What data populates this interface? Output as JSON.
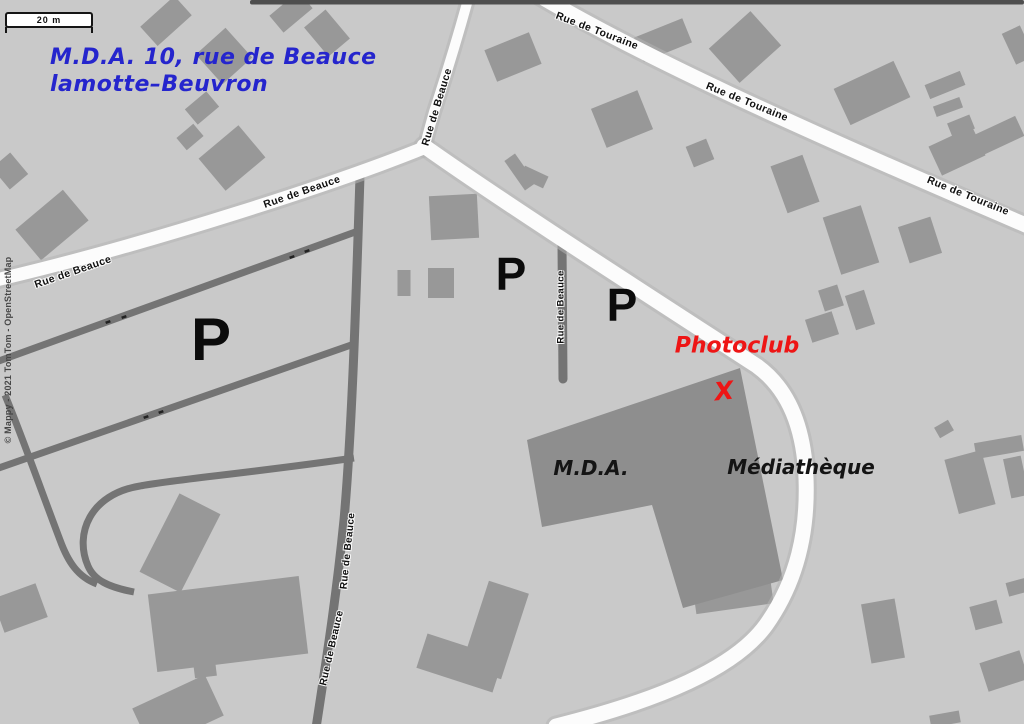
{
  "scale_bar": {
    "label": "20 m"
  },
  "copyright": "© Mappy - 2021 TomTom - OpenStreetMap",
  "annotation": {
    "address_line1": "M.D.A. 10, rue de Beauce",
    "address_line2": "lamotte–Beuvron",
    "photoclub": "Photoclub",
    "x_marker": "X",
    "mda": "M.D.A.",
    "mediatheque": "Médiathèque",
    "color_blue": "#2525cd",
    "color_red": "#ee1515",
    "color_black": "#141414"
  },
  "parking": {
    "symbol": "P",
    "markers": [
      {
        "x": 211,
        "y": 340,
        "size": 60
      },
      {
        "x": 511,
        "y": 274,
        "size": 46
      },
      {
        "x": 622,
        "y": 305,
        "size": 46
      }
    ]
  },
  "street_labels": [
    {
      "text": "Rue de Touraine",
      "x": 597,
      "y": 31,
      "rot": 21,
      "size": 10.5
    },
    {
      "text": "Rue de Touraine",
      "x": 747,
      "y": 102,
      "rot": 22,
      "size": 10.5
    },
    {
      "text": "Rue de Touraine",
      "x": 968,
      "y": 196,
      "rot": 22,
      "size": 10.5
    },
    {
      "text": "Rue de Beauce",
      "x": 437,
      "y": 107,
      "rot": -73,
      "size": 10.5
    },
    {
      "text": "Rue de Beauce",
      "x": 302,
      "y": 192,
      "rot": -19,
      "size": 10.5
    },
    {
      "text": "Rue de Beauce",
      "x": 73,
      "y": 272,
      "rot": -19,
      "size": 10.5
    },
    {
      "text": "Rue de Beauce",
      "x": 561,
      "y": 307,
      "rot": -90,
      "size": 9.5
    },
    {
      "text": "Rue de Beauce",
      "x": 348,
      "y": 551,
      "rot": -84,
      "size": 10
    },
    {
      "text": "Rue de Beauce",
      "x": 332,
      "y": 648,
      "rot": -77,
      "size": 10
    }
  ],
  "map": {
    "width": 1024,
    "height": 724,
    "colors": {
      "background": "#c9c9c9",
      "building": "#989898",
      "building_main": "#8e8e8e",
      "road_white": "#fcfcfc",
      "road_casing": "#b5b5b5",
      "road_minor": "#747474",
      "dot": "#222222"
    },
    "top_strip": {
      "x": 250,
      "h": 4.5,
      "color": "#4e4e4e"
    },
    "buildings": [
      [
        166,
        21,
        46,
        26,
        -42
      ],
      [
        224,
        56,
        40,
        40,
        -42
      ],
      [
        291,
        12,
        38,
        22,
        -40
      ],
      [
        327,
        33,
        28,
        38,
        -40
      ],
      [
        202,
        108,
        28,
        20,
        -40
      ],
      [
        232,
        158,
        52,
        42,
        -40
      ],
      [
        190,
        137,
        22,
        16,
        -40
      ],
      [
        52,
        225,
        62,
        40,
        -40
      ],
      [
        10,
        171,
        24,
        28,
        -40
      ],
      [
        513,
        57,
        48,
        34,
        -22
      ],
      [
        663,
        40,
        52,
        26,
        -22
      ],
      [
        622,
        119,
        50,
        42,
        -22
      ],
      [
        700,
        153,
        22,
        22,
        -22
      ],
      [
        745,
        47,
        56,
        46,
        -42
      ],
      [
        872,
        93,
        66,
        40,
        -25
      ],
      [
        945,
        85,
        38,
        15,
        -22
      ],
      [
        948,
        107,
        28,
        11,
        -20
      ],
      [
        961,
        126,
        24,
        15,
        -22
      ],
      [
        998,
        136,
        48,
        22,
        -25
      ],
      [
        1018,
        45,
        20,
        34,
        -25
      ],
      [
        957,
        151,
        48,
        32,
        -25
      ],
      [
        795,
        184,
        34,
        50,
        -20
      ],
      [
        851,
        240,
        40,
        60,
        -18
      ],
      [
        920,
        240,
        34,
        38,
        -18
      ],
      [
        831,
        298,
        20,
        22,
        -18
      ],
      [
        860,
        310,
        20,
        36,
        -18
      ],
      [
        822,
        327,
        28,
        24,
        -18
      ],
      [
        944,
        429,
        16,
        12,
        -30
      ],
      [
        999,
        447,
        48,
        16,
        -10
      ],
      [
        970,
        482,
        38,
        56,
        -15
      ],
      [
        1016,
        477,
        18,
        40,
        -12
      ],
      [
        883,
        631,
        34,
        60,
        -10
      ],
      [
        1018,
        587,
        22,
        14,
        -15
      ],
      [
        986,
        615,
        28,
        24,
        -15
      ],
      [
        1004,
        671,
        42,
        30,
        -18
      ],
      [
        945,
        719,
        30,
        12,
        -10
      ],
      [
        454,
        217,
        48,
        44,
        -3
      ],
      [
        404,
        283,
        13,
        26,
        0
      ],
      [
        441,
        283,
        26,
        30,
        0
      ],
      [
        520,
        172,
        13,
        36,
        -35
      ],
      [
        534,
        177,
        26,
        13,
        25
      ],
      [
        495,
        630,
        42,
        90,
        18
      ],
      [
        460,
        663,
        80,
        36,
        18
      ],
      [
        731,
        580,
        78,
        58,
        -8
      ],
      [
        180,
        543,
        46,
        88,
        27
      ],
      [
        228,
        624,
        152,
        78,
        -7
      ],
      [
        205,
        669,
        22,
        16,
        -7
      ],
      [
        20,
        608,
        46,
        36,
        -20
      ],
      [
        178,
        712,
        80,
        45,
        -25
      ]
    ],
    "polygons": [
      {
        "id": "mediatheque-mda-building",
        "points": "527,440 740,368 783,580 683,608 652,505 542,527",
        "fill": "#8e8e8e"
      }
    ],
    "roads": {
      "white": [
        {
          "id": "rue-de-touraine",
          "d": "M 540,-4 C 640,55 780,120 1028,226",
          "w": 15
        },
        {
          "id": "rue-de-beauce-north",
          "d": "M 469,-4 C 452,58 441,90 434,112 C 429,130 426,140 424,150",
          "w": 10
        },
        {
          "id": "rue-de-beauce-sw",
          "d": "M 426,147 C 340,182 150,244 -4,280",
          "w": 13
        },
        {
          "id": "main-road-southeast",
          "d": "M 424,146 C 500,200 640,290 757,366 C 790,390 804,430 806,478 C 808,530 798,580 766,625 C 735,668 660,700 556,726",
          "w": 15
        }
      ],
      "minor": [
        {
          "id": "rue-de-beauce-south",
          "d": "M 360,176 C 356,300 352,430 344,520 C 336,600 326,662 316,728",
          "w": 9
        },
        {
          "id": "rue-de-beauce-stub",
          "d": "M 562,243 L 563,379",
          "w": 9,
          "cap": "round"
        },
        {
          "id": "parking-aisle-1",
          "d": "M 358,231 L -4,362",
          "w": 7
        },
        {
          "id": "parking-aisle-2",
          "d": "M 354,344 L -4,469",
          "w": 7
        },
        {
          "id": "parking-aisle-3",
          "d": "M 354,458 C 250,473 170,480 140,486 C 90,494 74,534 88,566 C 94,580 108,587 134,592",
          "w": 7
        },
        {
          "id": "parking-connector",
          "d": "M 5,395 C 22,436 44,498 60,540 C 68,562 78,577 97,584",
          "w": 7
        }
      ]
    },
    "parking_dots": [
      [
        108,
        322
      ],
      [
        124,
        317
      ],
      [
        292,
        257
      ],
      [
        307,
        251
      ],
      [
        146,
        417
      ],
      [
        161,
        412
      ]
    ]
  }
}
